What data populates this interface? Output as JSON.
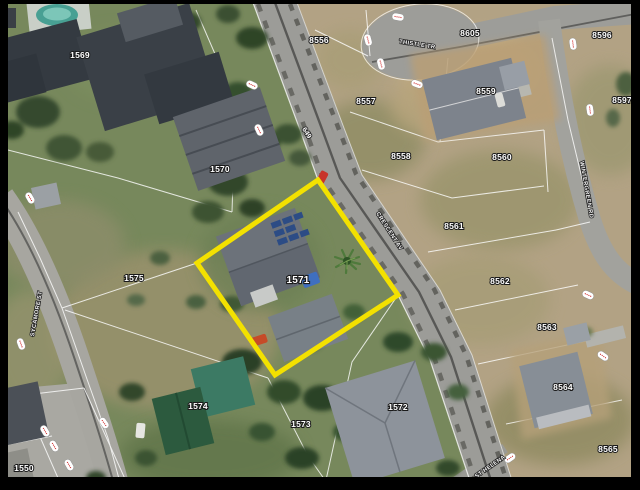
{
  "map": {
    "description": "Aerial parcel map with highlighted lot",
    "highlighted_parcel": {
      "id": "1571",
      "outline_color": "#f3e100",
      "polygon": [
        [
          318,
          180
        ],
        [
          398,
          295
        ],
        [
          275,
          375
        ],
        [
          197,
          263
        ]
      ]
    },
    "lot_labels": [
      {
        "id": "1569",
        "x": 80,
        "y": 58
      },
      {
        "id": "1570",
        "x": 220,
        "y": 172
      },
      {
        "id": "1571",
        "x": 298,
        "y": 283,
        "emphasis": true
      },
      {
        "id": "1575",
        "x": 134,
        "y": 281
      },
      {
        "id": "1574",
        "x": 198,
        "y": 409
      },
      {
        "id": "1573",
        "x": 301,
        "y": 427
      },
      {
        "id": "1572",
        "x": 398,
        "y": 410
      },
      {
        "id": "1550",
        "x": 24,
        "y": 471
      },
      {
        "id": "8556",
        "x": 319,
        "y": 43
      },
      {
        "id": "8605",
        "x": 470,
        "y": 36
      },
      {
        "id": "8557",
        "x": 366,
        "y": 104
      },
      {
        "id": "8558",
        "x": 401,
        "y": 159
      },
      {
        "id": "8559",
        "x": 486,
        "y": 94
      },
      {
        "id": "8560",
        "x": 502,
        "y": 160
      },
      {
        "id": "8561",
        "x": 454,
        "y": 229
      },
      {
        "id": "8562",
        "x": 500,
        "y": 284
      },
      {
        "id": "8563",
        "x": 547,
        "y": 330
      },
      {
        "id": "8564",
        "x": 563,
        "y": 390
      },
      {
        "id": "8565",
        "x": 608,
        "y": 452
      },
      {
        "id": "8596",
        "x": 602,
        "y": 38
      },
      {
        "id": "8597",
        "x": 622,
        "y": 103
      }
    ],
    "street_labels": [
      {
        "name": "CRESCENT AV",
        "x": 388,
        "y": 232,
        "rot": 57
      },
      {
        "name": "SYCAMORE ST",
        "x": 38,
        "y": 314,
        "rot": -80
      },
      {
        "name": "WINTERGREEN RD",
        "x": 585,
        "y": 190,
        "rot": 80
      },
      {
        "name": "THISTLE TR",
        "x": 417,
        "y": 46,
        "rot": 9
      },
      {
        "name": "ST HELENA",
        "x": 491,
        "y": 468,
        "rot": -35
      },
      {
        "name": "649",
        "x": 305,
        "y": 134,
        "rot": 57
      }
    ],
    "dimension_markers": [
      {
        "x": 252,
        "y": 85,
        "rot": 25
      },
      {
        "x": 30,
        "y": 198,
        "rot": 60
      },
      {
        "x": 21,
        "y": 344,
        "rot": 70
      },
      {
        "x": 45,
        "y": 431,
        "rot": 60
      },
      {
        "x": 54,
        "y": 446,
        "rot": 60
      },
      {
        "x": 69,
        "y": 465,
        "rot": 60
      },
      {
        "x": 104,
        "y": 423,
        "rot": 55
      },
      {
        "x": 398,
        "y": 17,
        "rot": 10
      },
      {
        "x": 368,
        "y": 40,
        "rot": 75
      },
      {
        "x": 381,
        "y": 64,
        "rot": 75
      },
      {
        "x": 417,
        "y": 84,
        "rot": 20
      },
      {
        "x": 573,
        "y": 44,
        "rot": 82
      },
      {
        "x": 590,
        "y": 110,
        "rot": 82
      },
      {
        "x": 588,
        "y": 295,
        "rot": 25
      },
      {
        "x": 603,
        "y": 356,
        "rot": 35
      },
      {
        "x": 510,
        "y": 458,
        "rot": -35
      },
      {
        "x": 259,
        "y": 130,
        "rot": 65
      }
    ],
    "colors": {
      "highlight": "#f3e100",
      "parcel_line": "#ffffff",
      "label_text": "#ffffff",
      "label_halo": "#1a1a1a",
      "marker_fill": "#ffffff",
      "marker_text": "#cc2222",
      "frame": "#000000"
    }
  }
}
